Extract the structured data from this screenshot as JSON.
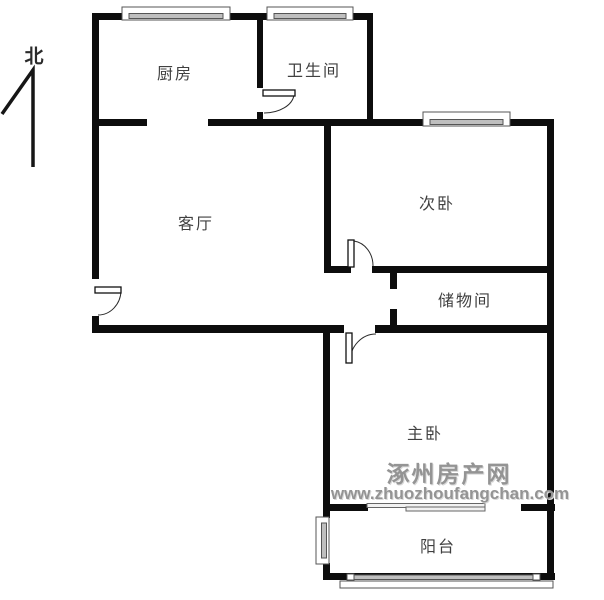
{
  "plan": {
    "north_label": "北",
    "rooms": {
      "kitchen": {
        "label": "厨房"
      },
      "bathroom": {
        "label": "卫生间"
      },
      "living_room": {
        "label": "客厅"
      },
      "secondary_bedroom": {
        "label": "次卧"
      },
      "storage_room": {
        "label": "储物间"
      },
      "master_bedroom": {
        "label": "主卧"
      },
      "balcony": {
        "label": "阳台"
      }
    },
    "features": {
      "doors": [
        "entry-door",
        "bathroom-door",
        "secondary-bedroom-door",
        "master-bedroom-door",
        "balcony-sliding-door",
        "storage-doorway"
      ],
      "windows": [
        "kitchen-window",
        "bathroom-window",
        "secondary-bedroom-window",
        "balcony-side-window",
        "balcony-front-window"
      ]
    }
  },
  "watermark": {
    "site_name": "涿州房产网",
    "site_url": "www.zhuozhoufangchan.com"
  },
  "colors": {
    "background": "#ffffff",
    "wall": "#0d0d0d",
    "room_label_text": "#404040",
    "watermark_text": "#949494",
    "window_glazing": "#bfbfbf",
    "window_frame": "#555555"
  }
}
